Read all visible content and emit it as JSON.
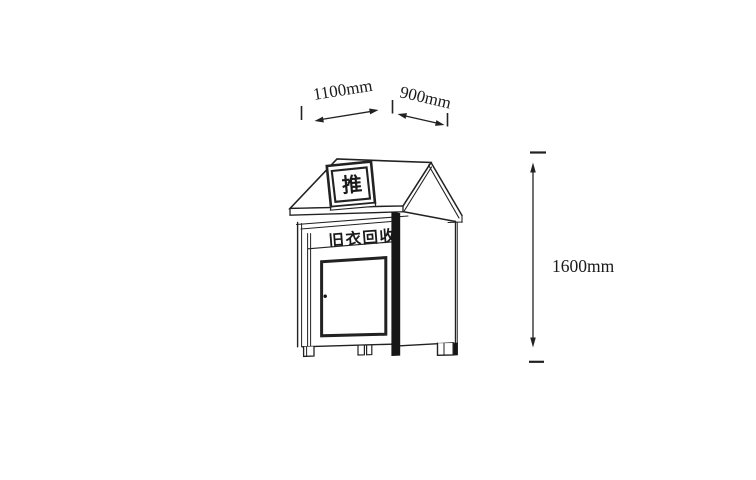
{
  "diagram": {
    "type": "technical-drawing",
    "subject": "house-shaped clothing recycling donation box, three-quarter perspective line drawing",
    "colors": {
      "background": "#ffffff",
      "line": "#222222",
      "corner_post": "#161616"
    },
    "dimensions": {
      "front_width": "1100mm",
      "side_depth": "900mm",
      "height": "1600mm"
    },
    "bin": {
      "roof_sign_label": "推",
      "front_label": "旧衣回收"
    }
  }
}
